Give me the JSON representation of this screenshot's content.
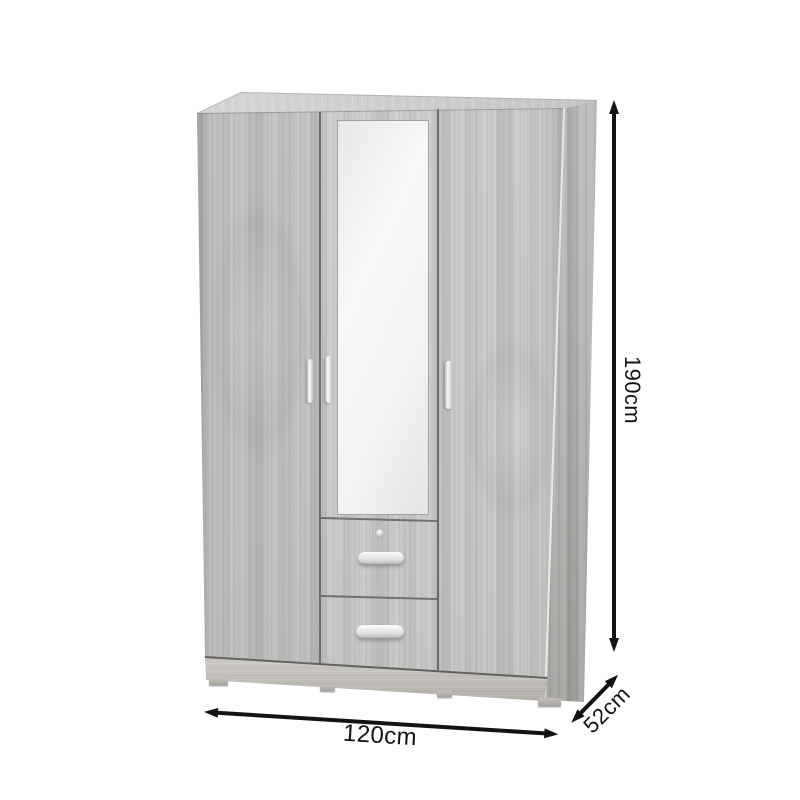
{
  "meta": {
    "background_color": "#ffffff",
    "subject": "three-door wardrobe with center mirror door and two drawers, grey oak finish, shown with dimension arrows"
  },
  "dimensions": {
    "height": {
      "label": "190cm"
    },
    "width": {
      "label": "120cm"
    },
    "depth": {
      "label": "52cm"
    }
  },
  "colors": {
    "wood_front": "#c6c5c3",
    "wood_top": "#d3d2d0",
    "wood_side": "#b6b5b3",
    "plinth": "#c6c3bd",
    "mirror": "#f2f2f2",
    "handle": "#ededed",
    "arrow": "#131313",
    "label_text": "#141414"
  }
}
